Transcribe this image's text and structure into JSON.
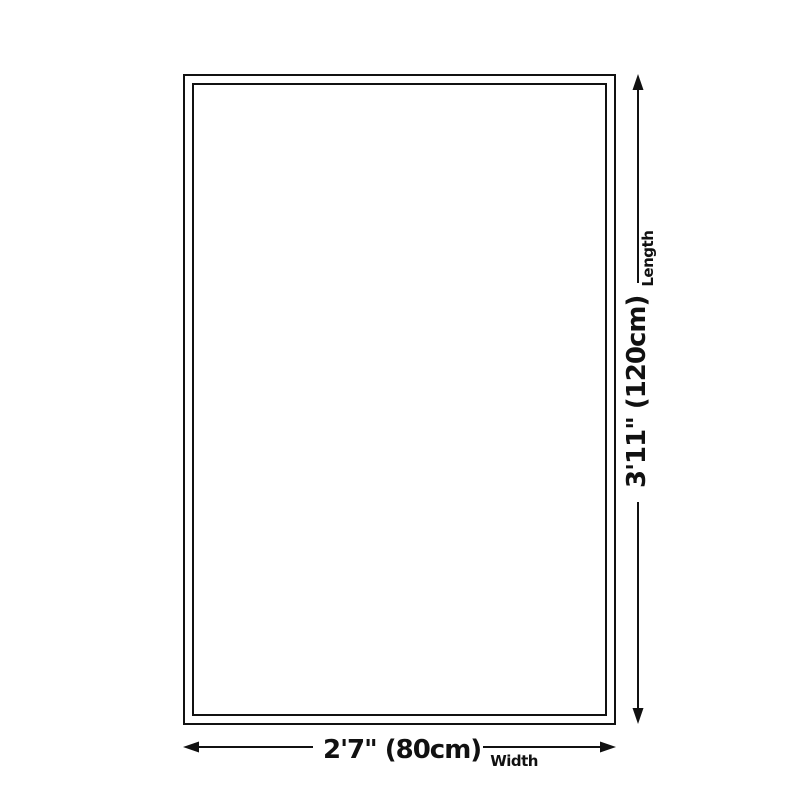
{
  "diagram": {
    "width": {
      "value": "2'7\" (80cm)",
      "caption": "Width"
    },
    "length": {
      "value": "3'11\" (120cm)",
      "caption": "Length"
    },
    "colors": {
      "line": "#111111",
      "background": "#ffffff"
    }
  }
}
